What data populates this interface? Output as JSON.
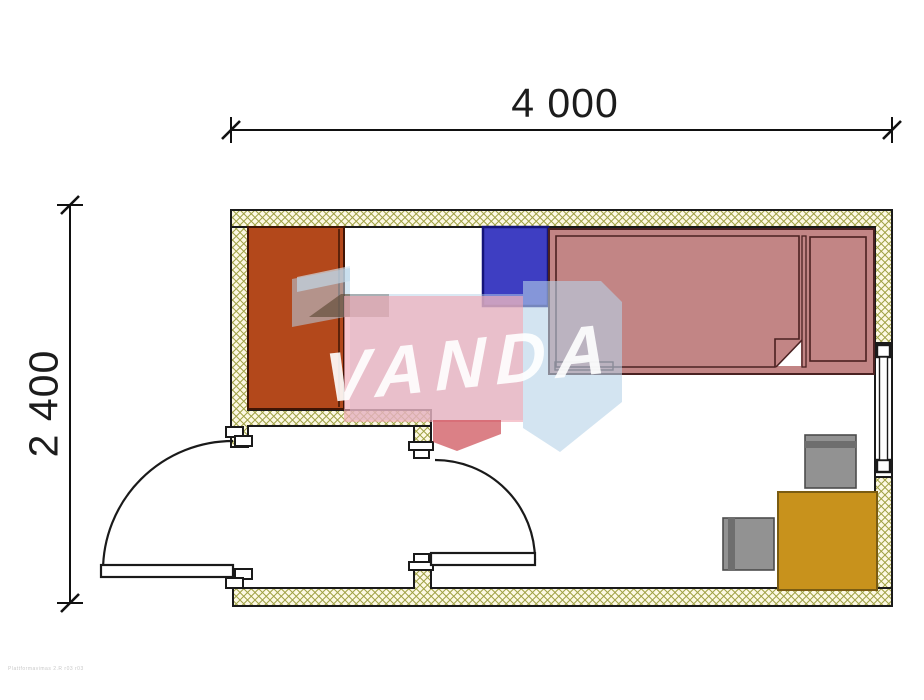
{
  "plan": {
    "dimension_width_label": "4 000",
    "dimension_height_label": "2 400",
    "watermark_text": "VANDA",
    "footer_text": "Plattformavimas 2.R r03 r03"
  },
  "colors": {
    "outline": "#1a1a1a",
    "wall_hatch_bg": "#fdf9e4",
    "wall_hatch_line": "#a0a245",
    "wardrobe": "#b3481b",
    "wardrobe_border": "#401505",
    "nightstand": "#3e3ec2",
    "nightstand_border": "#14147a",
    "bed": "#c28585",
    "bed_border": "#4a2121",
    "desk": "#c8921c",
    "desk_border": "#7a5c12",
    "chair": "#929292",
    "chair_band": "#6e6e6e",
    "chair_border": "#4c4c4c",
    "dimension": "#111111",
    "watermark_blue": "#b5d2e8",
    "watermark_blue_light": "#d4e6f2",
    "watermark_pink": "#f2aab6",
    "watermark_red": "#cc4a52",
    "watermark_dark": "#5a4630"
  },
  "furniture": [
    {
      "name": "wardrobe",
      "color": "#b3481b"
    },
    {
      "name": "nightstand",
      "color": "#3e3ec2"
    },
    {
      "name": "single-bed-with-pillow",
      "color": "#c28585"
    },
    {
      "name": "desk",
      "color": "#c8921c"
    },
    {
      "name": "chair-top",
      "color": "#929292"
    },
    {
      "name": "chair-left",
      "color": "#929292"
    }
  ],
  "openings": [
    {
      "name": "entry-door-outer",
      "swing": "quarter-arc-left"
    },
    {
      "name": "entry-door-inner",
      "swing": "quarter-arc-right"
    },
    {
      "name": "window-right-wall"
    }
  ]
}
